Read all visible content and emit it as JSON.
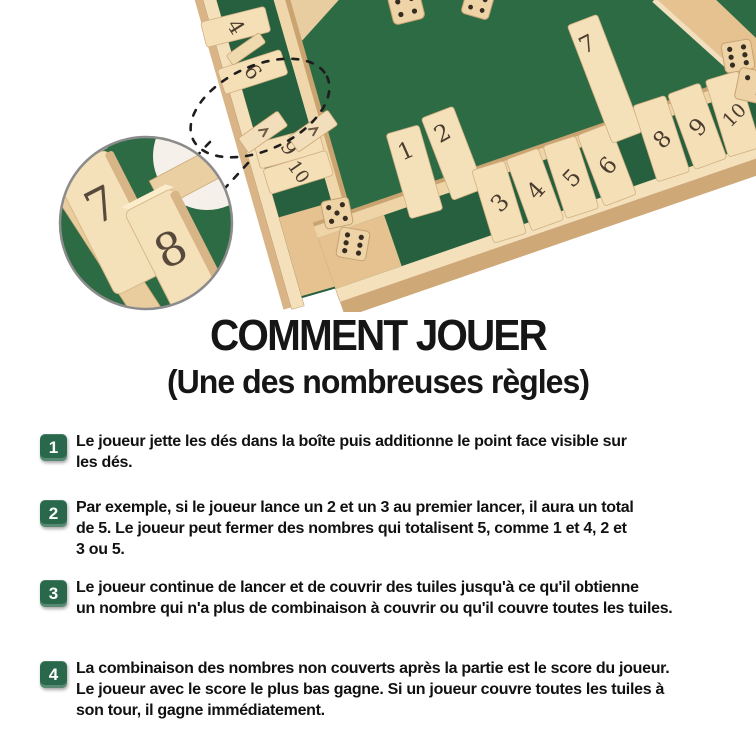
{
  "title": "COMMENT JOUER",
  "subtitle": "(Une des nombreuses règles)",
  "steps": [
    {
      "number": "1",
      "text": "Le joueur jette les dés dans la boîte puis additionne le point face visible sur\nles dés."
    },
    {
      "number": "2",
      "text": "Par exemple, si le joueur lance un 2 et un 3 au premier lancer, il aura un total\nde 5. Le joueur peut fermer des nombres qui totalisent 5, comme 1 et 4, 2 et\n3 ou 5."
    },
    {
      "number": "3",
      "text": "Le joueur continue de lancer et de couvrir des tuiles jusqu'à ce qu'il obtienne\nun nombre qui n'a plus de combinaison à couvrir ou qu'il couvre toutes les tuiles."
    },
    {
      "number": "4",
      "text": "La combinaison des nombres non couverts après la partie est le score du joueur.\nLe joueur avec le score le plus bas gagne. Si un joueur couvre toutes les tuiles à\nson tour, il gagne immédiatement."
    }
  ],
  "photo": {
    "board": {
      "left_tiles": [
        "4",
        "6",
        "9",
        "10"
      ],
      "standing_tiles": [
        "1",
        "2",
        "7"
      ],
      "flat_tiles": [
        "3",
        "4",
        "5",
        "6",
        "8",
        "9",
        "10"
      ]
    },
    "magnifier": {
      "tiles": [
        "7",
        "8"
      ]
    }
  },
  "colors": {
    "badge_green": "#2a684c",
    "felt_green": "#2d6b45",
    "wood_light": "#f2ddb4",
    "text": "#141414"
  }
}
